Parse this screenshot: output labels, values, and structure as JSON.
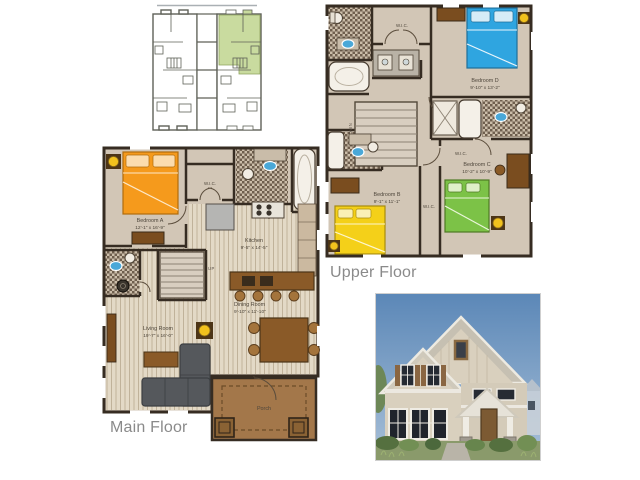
{
  "sheet": {
    "type": "floor-plan-sheet",
    "background": "#ffffff"
  },
  "key_plan": {
    "highlight_color": "#c9db9f",
    "line_color": "#5f6158"
  },
  "upper_floor": {
    "label": "Upper Floor",
    "wic_label": "W.I.C.",
    "stairs_label": "DOWN",
    "bedroom_b": {
      "name": "Bedroom B",
      "dims": "9'-1\" x 11'-1\"",
      "bed_color": "#f4d019"
    },
    "bedroom_c": {
      "name": "Bedroom C",
      "dims": "10'-2\" x 10'-9\"",
      "bed_color": "#7cc247"
    },
    "bedroom_d": {
      "name": "Bedroom D",
      "dims": "9'-10\" x 13'-2\"",
      "bed_color": "#2fa5e0"
    }
  },
  "main_floor": {
    "label": "Main Floor",
    "wic_label": "W.I.C.",
    "stairs_label": "UP",
    "bedroom_a": {
      "name": "Bedroom A",
      "dims": "12'-1\" x 16'-9\"",
      "bed_color": "#f59a1c"
    },
    "kitchen": {
      "name": "Kitchen",
      "dims": "9'-5\" x 14'-5\""
    },
    "dining_room": {
      "name": "Dining Room",
      "dims": "9'-10\" x 11'-10\""
    },
    "living_room": {
      "name": "Living Room",
      "dims": "19'-7\" x 16'-0\""
    },
    "porch": {
      "name": "Porch"
    }
  },
  "palette": {
    "wall": "#362c22",
    "floor_tan": "#d2c6b6",
    "wood_floor": "#e3d9c6",
    "porch_brown": "#a3774a",
    "furniture_brown": "#8a5a28",
    "lamp_yellow": "#f2c21d",
    "sofa_gray": "#55585c"
  }
}
